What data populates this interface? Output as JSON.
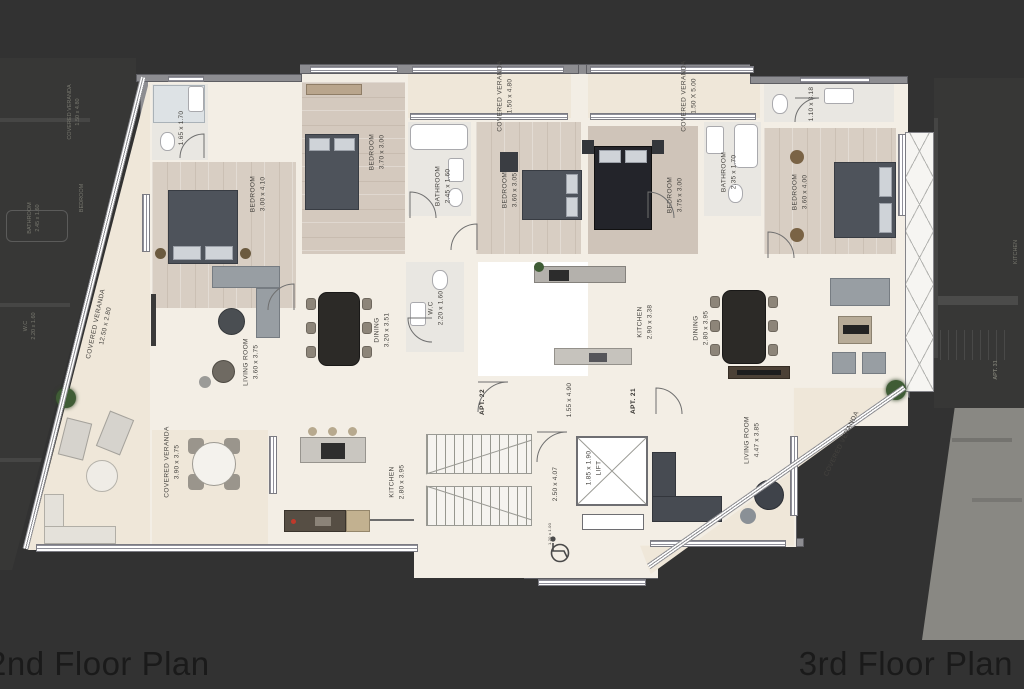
{
  "page": {
    "caption_left": "2nd Floor Plan",
    "caption_right": "3rd Floor Plan",
    "background": "#323232",
    "floor_cream": "#f3eee5",
    "wall_gray": "#8d8d91"
  },
  "plan": {
    "apartments": {
      "apt22": {
        "label": "APT. 22"
      },
      "apt21": {
        "label": "APT. 21"
      }
    },
    "rooms": {
      "bath_tl": {
        "name": "",
        "dims": "1.65 x 1.70"
      },
      "bed1": {
        "name": "BEDROOM",
        "dims": "3.00 x 4.10"
      },
      "bed2": {
        "name": "BEDROOM",
        "dims": "3.70 x 3.00"
      },
      "veranda_t1": {
        "name": "COVERED VERANDA",
        "dims": "1.50 x 4.80"
      },
      "bath2": {
        "name": "BATHROOM",
        "dims": "2.45 x 1.60"
      },
      "bed3": {
        "name": "BEDROOM",
        "dims": "3.60 x 3.05"
      },
      "veranda_t2": {
        "name": "COVERED VERANDA",
        "dims": "1.50 X 5.00"
      },
      "bed4": {
        "name": "BEDROOM",
        "dims": "3.75 x 3.00"
      },
      "bath_tr": {
        "name": "",
        "dims": "1.10 x 3.18"
      },
      "bath3": {
        "name": "BATHROOM",
        "dims": "2.35 x 1.70"
      },
      "bed5": {
        "name": "BEDROOM",
        "dims": "3.60 x 4.00"
      },
      "veranda_left": {
        "name": "COVERED VERANDA",
        "dims": "12.50 x 2.80"
      },
      "living22": {
        "name": "LIVING ROOM",
        "dims": "3.60 x 3.75"
      },
      "dining22": {
        "name": "DINING",
        "dims": "3.20 x 3.51"
      },
      "wc": {
        "name": "W.C",
        "dims": "2.20 x 1.60"
      },
      "hall22": {
        "name": "",
        "dims": "1.55 x 4.90"
      },
      "kitchen21": {
        "name": "KITCHEN",
        "dims": "2.90 x 3.38"
      },
      "dining21": {
        "name": "DINING",
        "dims": "2.80 x 3.95"
      },
      "living21": {
        "name": "LIVING ROOM",
        "dims": "4.47 x 3.85"
      },
      "veranda_right": {
        "name": "COVERED VERANDA",
        "dims": ""
      },
      "kitchen22": {
        "name": "KITCHEN",
        "dims": "2.80 x 3.95"
      },
      "stair_hall": {
        "name": "",
        "dims": "2.50 x 4.07"
      },
      "lift": {
        "name": "LIFT",
        "dims": "1.85 x 1.90"
      },
      "veranda_bl": {
        "name": "COVERED VERANDA",
        "dims": "3.90 x 3.75"
      },
      "access": {
        "name": "",
        "dims": "1.20 x 1.00"
      }
    }
  },
  "previews": {
    "left": {
      "veranda_name": "COVERED VERANDA",
      "veranda_dims": "1.50 x 4.80",
      "bathroom_name": "BATHROOM",
      "bathroom_dims": "2.45 x 1.60",
      "bedroom_name": "BEDROOM",
      "wc_name": "W.C",
      "wc_dims": "2.20 x 1.60"
    },
    "right": {
      "kitchen_name": "KITCHEN",
      "apt_label": "APT. 31"
    }
  }
}
